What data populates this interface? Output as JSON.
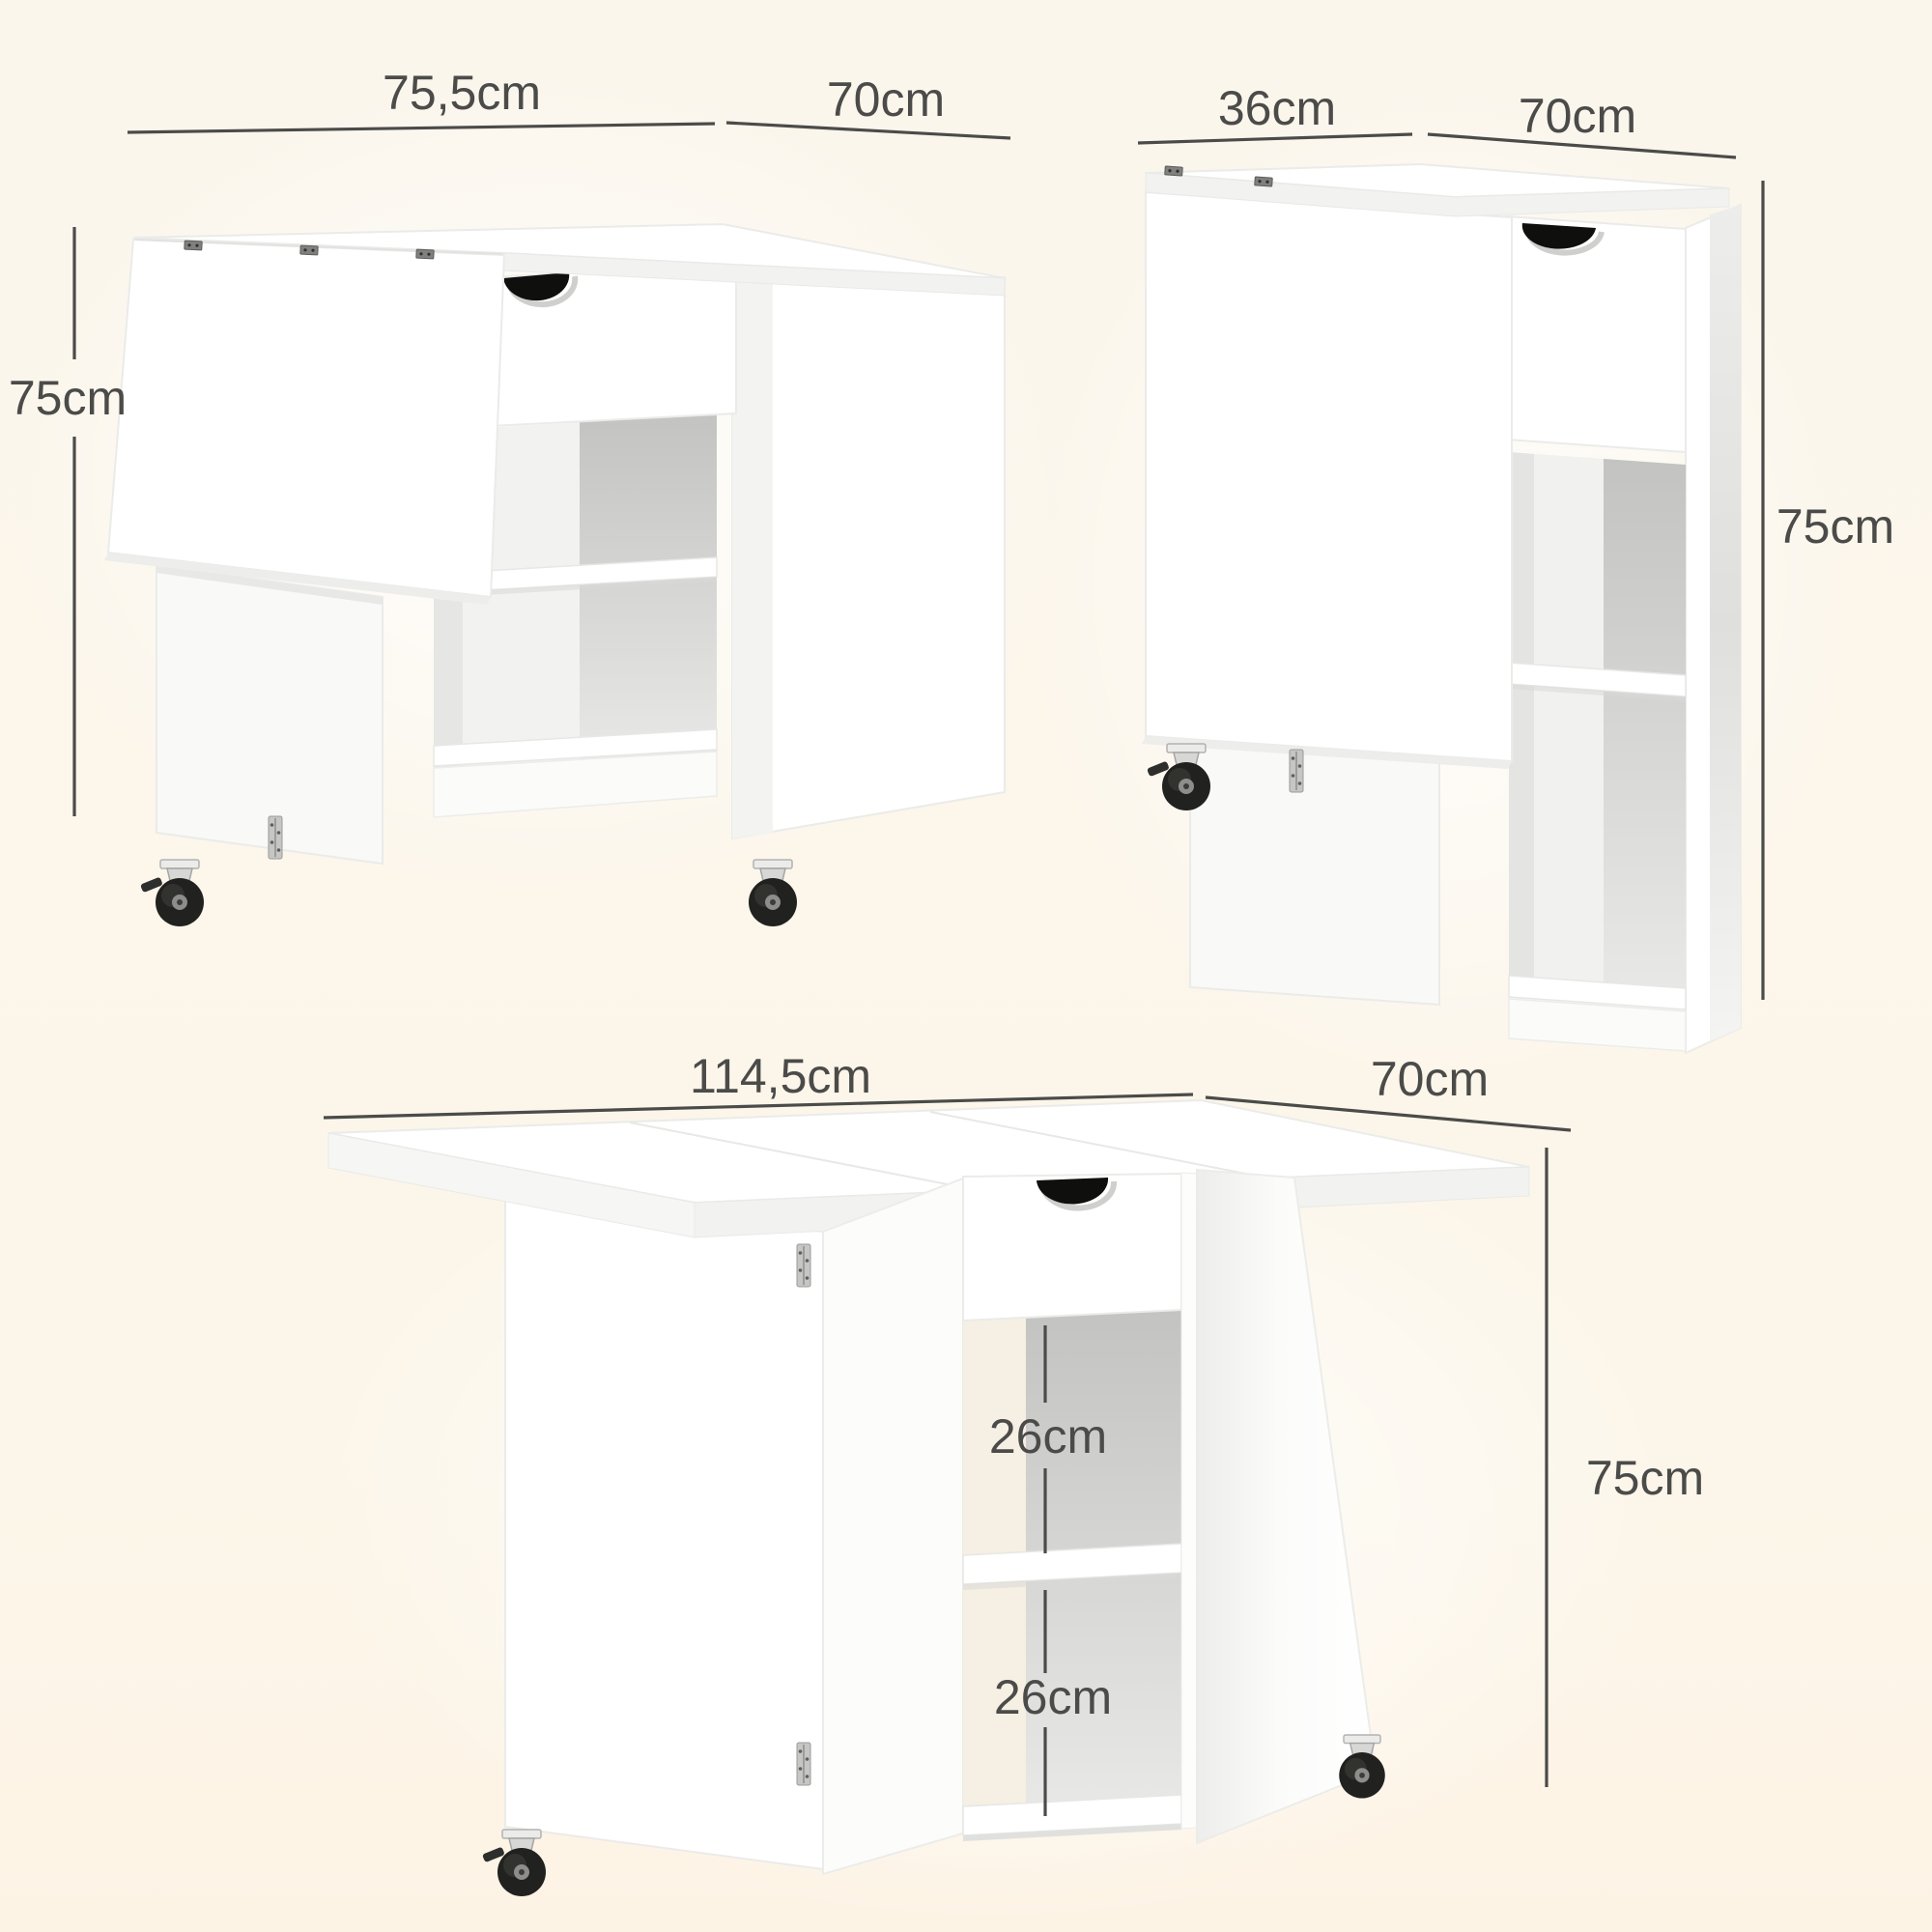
{
  "page": {
    "type": "product-dimension-diagram",
    "product": "white folding drop-leaf table with drawer, two open shelves and casters",
    "background_color": "#fcf6eb",
    "dimension_color": "#4b4b49",
    "furniture_color": "#ffffff",
    "cutout_color": "#0f0f0d"
  },
  "views": [
    {
      "name": "view-partially-open",
      "width_label": "75,5cm",
      "depth_label": "70cm",
      "height_label": "75cm"
    },
    {
      "name": "view-folded",
      "width_label": "36cm",
      "depth_label": "70cm",
      "height_label": "75cm"
    },
    {
      "name": "view-fully-open",
      "width_label": "114,5cm",
      "depth_label": "70cm",
      "height_label": "75cm",
      "upper_shelf_label": "26cm",
      "lower_shelf_label": "26cm"
    }
  ]
}
